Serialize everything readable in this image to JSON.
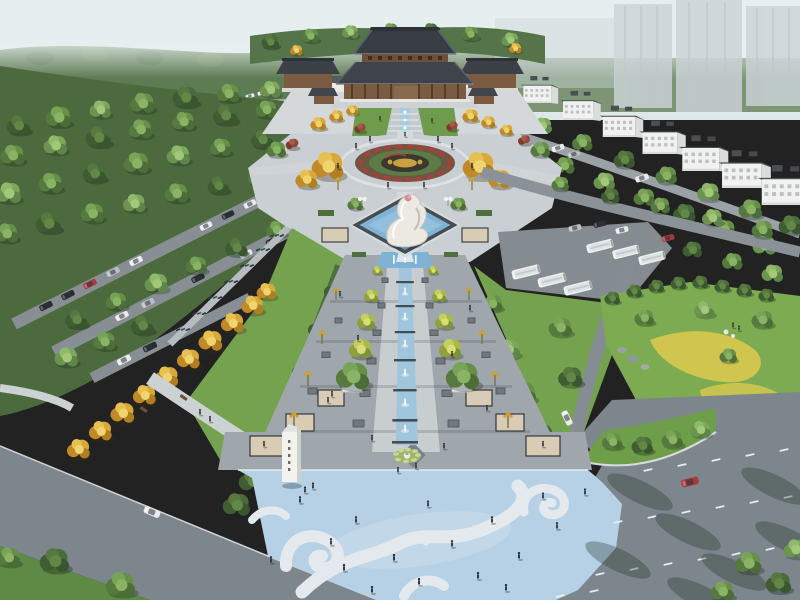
{
  "scene": {
    "type": "aerial architectural rendering",
    "subject": "Chinese temple cultural plaza: axial fountain promenade with ginkgo rows, circular parterre with gold emblem, white hand-and-bud fountain sculpture, cloud-motif blue square, tree-grove parking, coach lot, flower hill and perimeter roads",
    "legible_text": "none (stele characters too small to read)"
  },
  "landmarks": {
    "temple": "multi-tiered dark-roof grand hall with side wings and galleries",
    "flower_bed": "circular parterre, red scroll border, golden emblem on dark ground",
    "sculpture": "white abstract fountain sculpture with pink bud accent in diamond pool",
    "water_axis": "stepped fountain channel with jets ending at lotus medallion",
    "cloud_plaza": "light-blue pavement with white auspicious-cloud pattern",
    "stele": "white inscribed stele monument",
    "bus_lot": "six white coaches parked diagonally",
    "residential": "row of white low-rise blocks with dark stepped roofs",
    "towers": "faint high-rise slabs in haze"
  },
  "palette": {
    "sky": "#e7eef0",
    "forest_far": "#5e7c54",
    "forest_mass": "#4d6a3e",
    "lawn": "#74a24e",
    "hill": "#7cab51",
    "flower_yellow": "#d9c94f",
    "gold_tree": "#d8a93a",
    "axis_tree": "#b3bf52",
    "temple_roof": "#383d44",
    "temple_wood": "#7b5b42",
    "terrace": "#d4d8da",
    "plaza_paving": "#c9cfd3",
    "promenade_paving": "#9fa6ac",
    "paving_light": "#c8cdd0",
    "paving_beige": "#d8cdb4",
    "inset_dark": "#70777d",
    "plaza_blue": "#b6d1e6",
    "cloud": "#e4e9ed",
    "channel_water": "#9fc6dc",
    "pool_water": "#7fb3d6",
    "road": "#7e868d",
    "road_light": "#9aa2a8",
    "lane_dash": "#e8ecee",
    "building_white": "#f1f2f0",
    "building_roof": "#4a4f55",
    "tower_ghost": "#ccd4d8",
    "sculpture_white": "#ece9e3",
    "accent_pink": "#d9888f",
    "lamp_gold": "#c9a13b",
    "bed_red": "#a84038",
    "bed_soil": "#6a5844",
    "bed_dark": "#3b382f",
    "motif_gold": "#c9a23f",
    "car_white": "#e9ebec",
    "car_black": "#2a2d31",
    "car_silver": "#b9bec2",
    "car_red": "#a63b3e",
    "bus_white": "#eef0f1",
    "person": "#2b3137",
    "stele_white": "#f2f2ef",
    "path_light": "#ccd2d4",
    "hedge": "#4a6a3e"
  }
}
